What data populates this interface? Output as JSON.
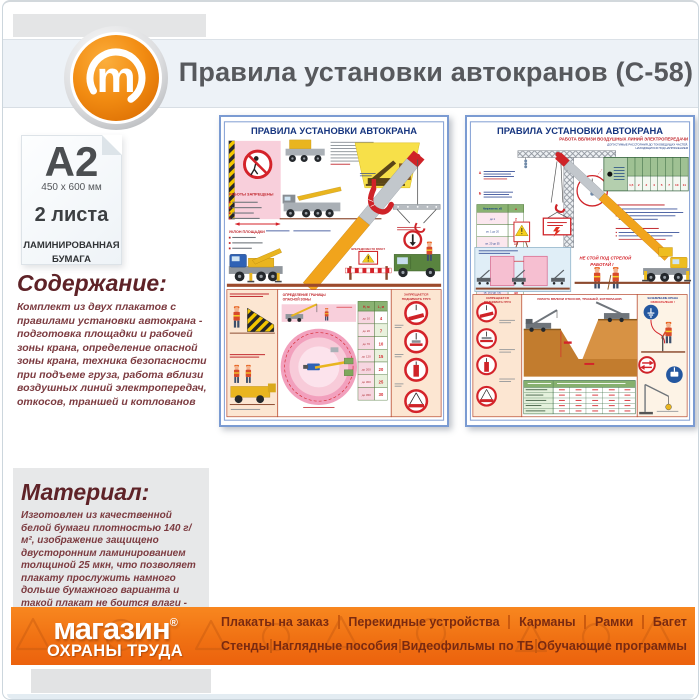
{
  "window": {
    "title": "Правила установки автокранов (С-58)",
    "logo_letter": "m"
  },
  "sidebar": {
    "format": "A2",
    "format_size": "450 x 600 мм",
    "sheets": "2 листа",
    "paper_type_line1": "ЛАМИНИРОВАННАЯ",
    "paper_type_line2": "БУМАГА",
    "content_heading": "Содержание:",
    "content_text": "Комплект из двух плакатов с правилами установки автокрана - подготовка площадки и рабочей зоны крана, определение опасной зоны крана, техника безопасности при подъеме груза, работа вблизи воздушных линий электропередач, откосов, траншей и котлованов",
    "material_heading": "Материал:",
    "material_text": "Изготовлен из качественной белой бумаги плотностью 140 г/м², изображение защищено двусторонним ламинированием толщиной 25 мкн, что позволяет плакату прослужить намного дольше бумажного варианта и такой плакат не боится влаги - его смело можно протирать."
  },
  "posters": {
    "shared_title": "ПРАВИЛА УСТАНОВКИ АВТОКРАНА",
    "no_lift_line1": "ЗАПРЕЩАЕТСЯ",
    "no_lift_line2": "ПОДНИМАТЬ ГРУЗ",
    "left": {
      "slope_label": "УКЛОН ПЛОЩАДКИ",
      "works_forbidden": "РАБОТЫ ЗАПРЕЩЕНЫ",
      "barrier_label": "ВПЕРЕДИ МЕСТО РАБОТ",
      "danger_zone_line1": "ОПРЕДЕЛЕНИЕ ГРАНИЦЫ",
      "danger_zone_line2": "ОПАСНОЙ ЗОНЫ",
      "zone_table": {
        "headers": [
          "Н, м",
          "L, м"
        ],
        "rows": [
          [
            "до 10",
            "4"
          ],
          [
            "до 20",
            "7"
          ],
          [
            "до 70",
            "10"
          ],
          [
            "до 120",
            "15"
          ],
          [
            "до 200",
            "20"
          ],
          [
            "до 300",
            "25"
          ],
          [
            "до 450",
            "30"
          ]
        ]
      }
    },
    "right": {
      "subtitle": "РАБОТА ВБЛИЗИ ВОЗДУШНЫХ ЛИНИЙ ЭЛЕКТРОПЕРЕДАЧИ",
      "subtitle2_line1": "ДОПУСТИМЫЕ РАССТОЯНИЯ ДО ТОКОВЕДУЩИХ ЧАСТЕЙ,",
      "subtitle2_line2": "НАХОДЯЩИХСЯ ПОД НАПРЯЖЕНИЕМ",
      "marker_a": "А",
      "marker_b": "Б",
      "voltage_table": {
        "headers": [
          "Напряжение, кВ",
          "м"
        ],
        "rows": [
          [
            "до 1",
            "2"
          ],
          [
            "св. 1 до 20",
            "10"
          ],
          [
            "св. 20 до 35",
            "15"
          ],
          [
            "св. 35 до 110",
            "20"
          ],
          [
            "св. 110 до 220",
            "25"
          ],
          [
            "св. 220 до 500",
            "30"
          ],
          [
            "св. 500 до 750",
            "40"
          ],
          [
            "св. 750 до 1150",
            "50"
          ]
        ]
      },
      "distance_row": [
        "1,5",
        "2",
        "2",
        "4",
        "5",
        "7",
        "10",
        "11"
      ],
      "no_stand_line1": "НЕ СТОЙ ПОД СТРЕЛОЙ",
      "no_stand_line2": "РАБОТАЙ !",
      "slopes_heading": "РАБОТА ВБЛИЗИ ОТКОСОВ, ТРАНШЕЙ, КОТЛОВАНОВ",
      "grounding_line1": "ЗАЗЕМЛЕНИЕ КРАНА",
      "grounding_line2": "ОБЯЗАТЕЛЬНО !"
    }
  },
  "footer": {
    "logo_line1": "магазин",
    "logo_reg": "®",
    "logo_line2": "ОХРАНЫ ТРУДА",
    "menu_row1": [
      "Плакаты на заказ",
      "Перекидные устройства",
      "Карманы",
      "Рамки",
      "Багет"
    ],
    "menu_row2": [
      "Стенды",
      "Наглядные пособия",
      "Видеофильмы по ТБ",
      "Обучающие программы"
    ]
  },
  "colors": {
    "accent_orange": "#f28c12",
    "footer_orange": "#f5831e",
    "heading_maroon": "#5e2227",
    "poster_border_blue": "#7b9bd2",
    "poster_title_navy": "#16357f",
    "safety_red": "#d4232a"
  }
}
